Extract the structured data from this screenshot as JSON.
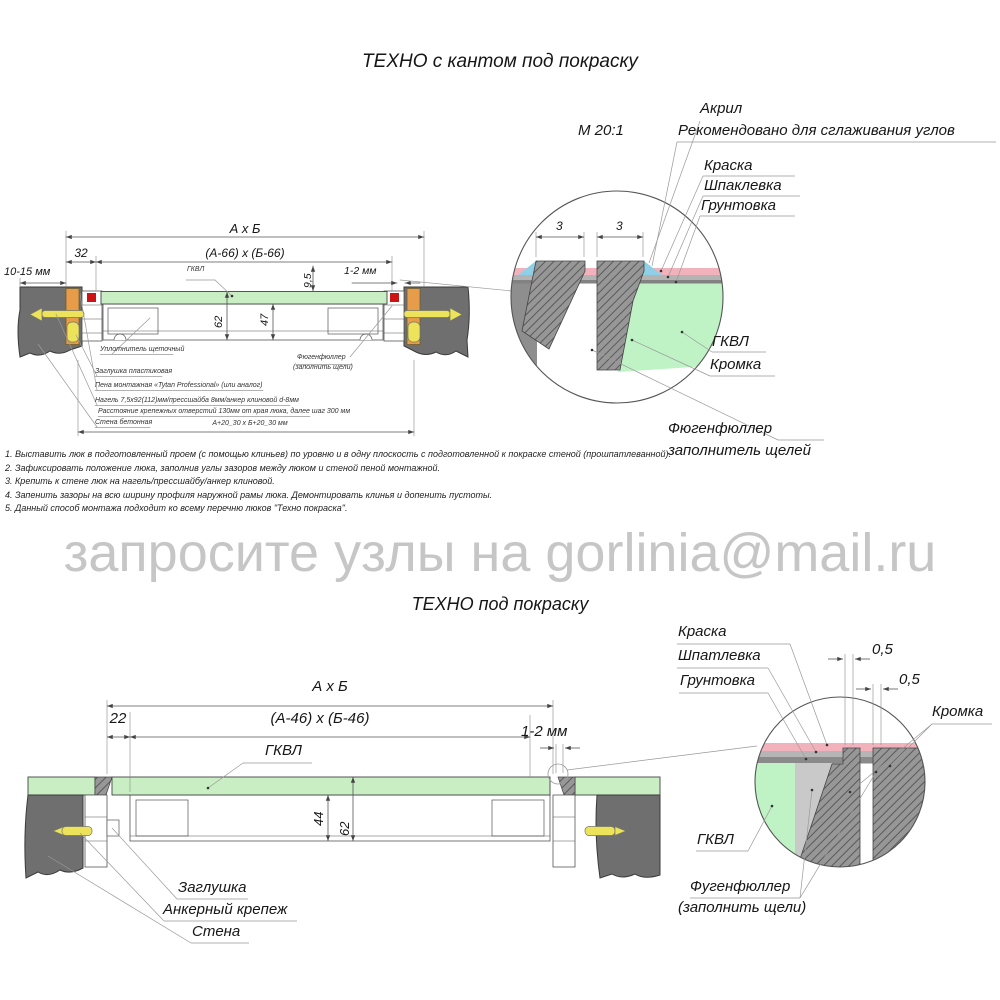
{
  "titles": {
    "top": "ТЕХНО с кантом под покраску",
    "bottom": "ТЕХНО под покраску"
  },
  "watermark": "запросите узлы на gorlinia@mail.ru",
  "detail_top": {
    "scale": "М 20:1",
    "acrylic": "Акрил",
    "recommended": "Рекомендовано для сглаживания углов",
    "paint": "Краска",
    "putty": "Шпаклевка",
    "primer": "Грунтовка",
    "gkvl": "ГКВЛ",
    "edge": "Кромка",
    "filler_line1": "Фюгенфюллер",
    "filler_line2": "заполнитель щелей",
    "dim_left": "3",
    "dim_right": "3"
  },
  "drawing_top": {
    "dim_axb": "А х Б",
    "dim_inner": "(А-66) х (Б-66)",
    "dim_32": "32",
    "dim_10_15": "10-15 мм",
    "dim_9_5": "9,5",
    "dim_1_2": "1-2 мм",
    "dim_62": "62",
    "dim_47": "47",
    "dim_bottom": "А+20_30 х Б+20_30 мм",
    "gkvl": "ГКВЛ",
    "seal": "Уплотнитель щеточный",
    "plug": "Заглушка пластиковая",
    "foam": "Пена монтажная «Tytan Professional» (или аналог)",
    "nagel": "Нагель 7,5х92(112)мм/прессшайба 8мм/анкер клиновой d-8мм",
    "spacing": "Расстояние крепежных отверстий 130мм от края люка, далее шаг 300 мм",
    "wall": "Стена бетонная",
    "filler_line1": "Фюгенфюллер",
    "filler_line2": "(заполнить щели)"
  },
  "notes": [
    "1. Выставить люк в подготовленный проем (с помощью клиньев) по уровню и в одну плоскость с подготовленной к покраске стеной (прошпатлеванной).",
    "2. Зафиксировать положение люка, заполнив углы зазоров между люком и стеной пеной монтажной.",
    "3. Крепить к стене люк на нагель/прессшайбу/анкер клиновой.",
    "4. Запенить зазоры на всю ширину профиля наружной рамы люка. Демонтировать клинья и допенить пустоты.",
    "5. Данный способ монтажа подходит ко всему перечню люков \"Техно покраска\"."
  ],
  "drawing_bottom": {
    "dim_axb": "А х Б",
    "dim_inner": "(А-46) х (Б-46)",
    "dim_22": "22",
    "dim_1_2": "1-2 мм",
    "dim_44": "44",
    "dim_62": "62",
    "gkvl": "ГКВЛ",
    "plug": "Заглушка",
    "anchor": "Анкерный крепеж",
    "wall": "Стена"
  },
  "detail_bottom": {
    "paint": "Краска",
    "putty": "Шпатлевка",
    "primer": "Грунтовка",
    "dim_05_a": "0,5",
    "dim_05_b": "0,5",
    "edge": "Кромка",
    "gkvl": "ГКВЛ",
    "filler_line1": "Фугенфюллер",
    "filler_line2": "(заполнить щели)"
  },
  "colors": {
    "wall": "#6f6f6f",
    "gkvl_panel": "#c9eec3",
    "gkvl_detail": "#bff2c4",
    "wedge_orange": "#e69c48",
    "anchor_yellow": "#ece35a",
    "seal_red": "#cc1212",
    "paint_pink": "#f2b2bc",
    "acrylic_blue": "#8fd0e6",
    "watermark": "#c6c6c6"
  }
}
